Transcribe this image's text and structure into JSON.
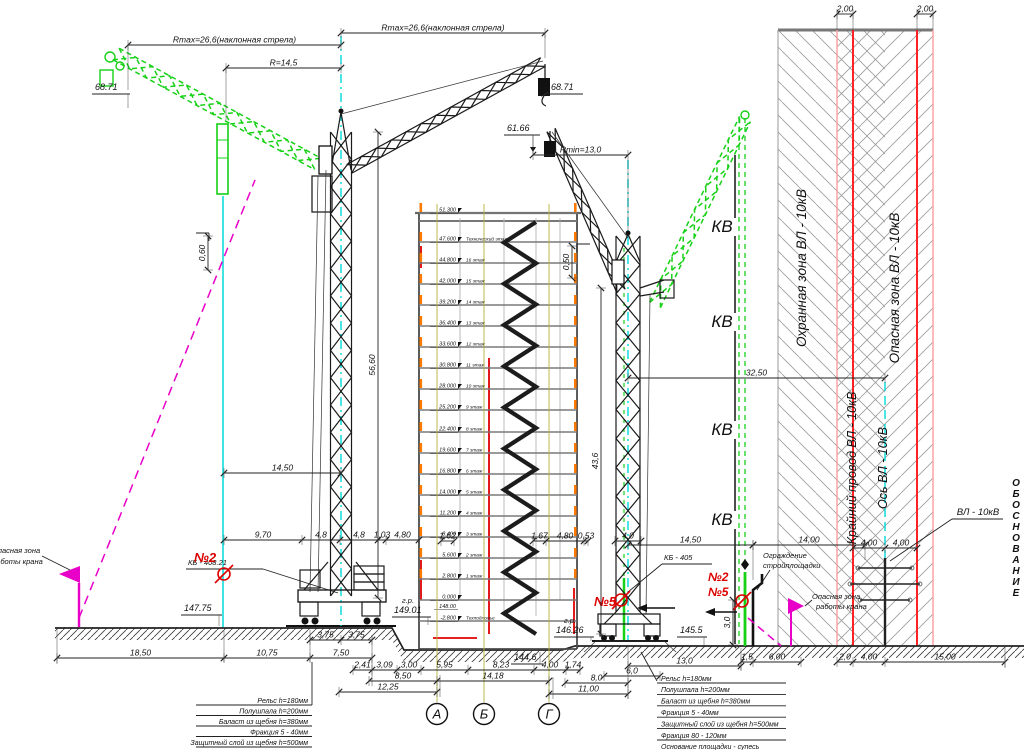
{
  "colors": {
    "green": "#17d117",
    "magenta": "#e800c8",
    "cyan": "#00d9d9",
    "red_accent": "#dd0000",
    "red_line": "#ff2222",
    "red_soft": "#ff9e9e",
    "orange": "#ff7a00",
    "olive": "#b3b335",
    "slab_gray": "#7a7a7a"
  },
  "labels": {
    "rmax_incline": "Rmax=26,6(наклонная стрела)",
    "r_current": "R=14,5",
    "rmin": "Rmin=13,0",
    "crane_left_model": "КБ - 408.21",
    "crane_right_model": "КБ - 405",
    "kv": "КВ",
    "zone_guard": "Охранная зона ВЛ - 10кВ",
    "zone_danger": "Опасная зона ВЛ - 10кВ",
    "wire_edge": "Крайний провод ВЛ - 10кВ",
    "vl_axis": "Ось ВЛ - 10кВ",
    "vl": "ВЛ - 10кВ",
    "fence_line1": "Ограждение",
    "fence_line2": "стройплощадки",
    "danger_line1": "Опасная зона",
    "danger_line2": "работы крана",
    "no2": "№2",
    "no5": "№5",
    "side_text": "ОБОСНОВАНИЕ"
  },
  "elevations": {
    "gr": "г.р.",
    "hook_left": "68.71",
    "hook_right": "61.66",
    "ground_left": "147.75",
    "rail_left": "149.01",
    "rail_right": "146.26",
    "ground_right": "145.5",
    "pit": "144.6"
  },
  "dim_rows": [
    {
      "y": 45,
      "pts": [
        128,
        341
      ],
      "texts": [
        "Rmax=26,6(наклонная стрела)"
      ]
    },
    {
      "y": 68,
      "pts": [
        226,
        341
      ],
      "texts": [
        "R=14,5"
      ]
    },
    {
      "y": 33,
      "pts": [
        341,
        545
      ],
      "texts": [
        "Rmax=26,6(наклонная стрела)"
      ]
    },
    {
      "y": 155,
      "pts": [
        533,
        628
      ],
      "texts": [
        "Rmin=13,0"
      ]
    },
    {
      "y": 378,
      "pts": [
        628,
        885
      ],
      "texts": [
        "32,50"
      ]
    },
    {
      "y": 14,
      "pts": [
        837,
        853
      ],
      "texts": [
        "2,00"
      ]
    },
    {
      "y": 14,
      "pts": [
        917,
        933
      ],
      "texts": [
        "2,00"
      ]
    },
    {
      "y": 473,
      "pts": [
        224,
        341
      ],
      "texts": [
        "14,50"
      ]
    },
    {
      "y": 540,
      "pts": [
        224,
        302,
        340,
        378,
        386,
        419
      ],
      "texts": [
        "9,70",
        "4,8",
        "4,8",
        "1,03",
        "4,80"
      ]
    },
    {
      "y": 541,
      "pts": [
        441,
        454
      ],
      "texts": [
        "1,62"
      ]
    },
    {
      "y": 541,
      "pts": [
        533,
        546,
        584,
        588
      ],
      "texts": [
        "1,67",
        "4,80",
        "0,53"
      ]
    },
    {
      "y": 541,
      "pts": [
        615,
        641
      ],
      "texts": [
        "4,0"
      ]
    },
    {
      "y": 545,
      "pts": [
        628,
        753
      ],
      "texts": [
        "14,50"
      ]
    },
    {
      "y": 545,
      "pts": [
        753,
        865
      ],
      "texts": [
        "14,00"
      ]
    },
    {
      "y": 548,
      "pts": [
        853,
        885,
        917
      ],
      "texts": [
        "4,00",
        "4,00"
      ]
    },
    {
      "y": 640,
      "pts": [
        310,
        341,
        372
      ],
      "texts": [
        "3,75",
        "3,75"
      ]
    },
    {
      "y": 658,
      "pts": [
        57,
        224,
        310,
        372
      ],
      "texts": [
        "18,50",
        "10,75",
        "7,50"
      ]
    },
    {
      "y": 670,
      "pts": [
        353,
        372,
        397,
        421,
        468,
        534,
        566,
        580
      ],
      "texts": [
        "2,41",
        "3,09",
        "3,00",
        "5,95",
        "8,23",
        "4,00",
        "1,74"
      ]
    },
    {
      "y": 681,
      "pts": [
        369,
        437,
        549
      ],
      "texts": [
        "8,50",
        "14,18"
      ]
    },
    {
      "y": 683,
      "pts": [
        565,
        628
      ],
      "texts": [
        "8,0"
      ]
    },
    {
      "y": 692,
      "pts": [
        339,
        437
      ],
      "texts": [
        "12,25"
      ]
    },
    {
      "y": 694,
      "pts": [
        549,
        628
      ],
      "texts": [
        "11,00"
      ]
    },
    {
      "y": 666,
      "pts": [
        628,
        741
      ],
      "texts": [
        "13,0"
      ]
    },
    {
      "y": 676,
      "pts": [
        604,
        660
      ],
      "texts": [
        "6,0"
      ]
    },
    {
      "y": 662,
      "pts": [
        741,
        753,
        801
      ],
      "texts": [
        "1,5",
        "6,00"
      ]
    },
    {
      "y": 662,
      "pts": [
        837,
        853,
        885,
        1005
      ],
      "texts": [
        "2,0",
        "4,00",
        "15,00"
      ]
    }
  ],
  "vdims": [
    {
      "x": 378,
      "y1": 132,
      "y2": 598,
      "t": "56,60"
    },
    {
      "x": 601,
      "y1": 288,
      "y2": 634,
      "t": "43,6"
    },
    {
      "x": 208,
      "y1": 236,
      "y2": 270,
      "t": "0,60"
    },
    {
      "x": 572,
      "y1": 246,
      "y2": 278,
      "t": "0,50"
    },
    {
      "x": 733,
      "y1": 600,
      "y2": 645,
      "t": "3,0"
    }
  ],
  "axes": {
    "labels": [
      "А",
      "Б",
      "Г"
    ],
    "xs": [
      437,
      484,
      549
    ],
    "y": 714
  },
  "kv_marks": {
    "x": 722,
    "ys": [
      232,
      327,
      435,
      525
    ]
  },
  "building": {
    "floors": [
      {
        "elev": "51.300",
        "y": 213,
        "label": ""
      },
      {
        "elev": "47.600",
        "y": 242,
        "label": "Технический этаж"
      },
      {
        "elev": "44.800",
        "y": 263,
        "label": "16 этаж"
      },
      {
        "elev": "42.000",
        "y": 284,
        "label": "15 этаж"
      },
      {
        "elev": "39.200",
        "y": 305,
        "label": "14 этаж"
      },
      {
        "elev": "36.400",
        "y": 326,
        "label": "13 этаж"
      },
      {
        "elev": "33.600",
        "y": 347,
        "label": "12 этаж"
      },
      {
        "elev": "30.800",
        "y": 368,
        "label": "11 этаж"
      },
      {
        "elev": "28.000",
        "y": 389,
        "label": "10 этаж"
      },
      {
        "elev": "25.200",
        "y": 410,
        "label": "9 этаж"
      },
      {
        "elev": "22.400",
        "y": 432,
        "label": "8 этаж"
      },
      {
        "elev": "19.600",
        "y": 453,
        "label": "7 этаж"
      },
      {
        "elev": "16.800",
        "y": 474,
        "label": "6 этаж"
      },
      {
        "elev": "14.000",
        "y": 495,
        "label": "5 этаж"
      },
      {
        "elev": "11.200",
        "y": 516,
        "label": "4 этаж"
      },
      {
        "elev": "8.400",
        "y": 537,
        "label": "3 этаж"
      },
      {
        "elev": "5.600",
        "y": 558,
        "label": "2 этаж"
      },
      {
        "elev": "2.800",
        "y": 579,
        "label": "1 этаж"
      },
      {
        "elev": "0.000",
        "y": 600,
        "label": "",
        "sub": "148.00"
      },
      {
        "elev": "-2.800",
        "y": 621,
        "label": "Техподполье"
      }
    ]
  },
  "tables": {
    "left": [
      "Рельс h=180мм",
      "Полушпала h=200мм",
      "Баласт из щебня h=380мм",
      "Фракция 5 - 40мм",
      "Защитный слой из щебня h=500мм"
    ],
    "right": [
      "Рельс h=180мм",
      "Полушпала h=200мм",
      "Баласт из щебня h=380мм",
      "Фракция 5 - 40мм",
      "Защитный слой из щебня h=500мм",
      "Фракция 80 - 120мм",
      "Основание площадки - супесь"
    ]
  }
}
